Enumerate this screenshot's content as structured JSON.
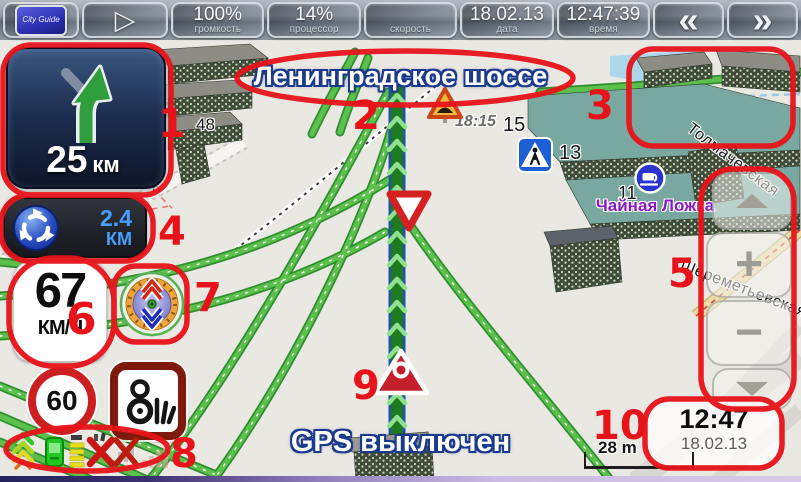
{
  "toolbar": {
    "logo_text": "City Guide",
    "play_glyph": "▷",
    "volume": {
      "value": "100%",
      "label": "громкость"
    },
    "cpu": {
      "value": "14%",
      "label": "процессор"
    },
    "speed": {
      "value": "",
      "label": "скорость"
    },
    "date": {
      "value": "18.02.13",
      "label": "дата"
    },
    "time": {
      "value": "12:47:39",
      "label": "время"
    },
    "back_glyph": "«",
    "forward_glyph": "»"
  },
  "maneuver_panel": {
    "distance": "25",
    "unit": "км"
  },
  "next_maneuver_panel": {
    "distance": "2.4",
    "unit": "КМ"
  },
  "speedometer": {
    "value": "67",
    "unit": "КМ/Ч"
  },
  "speed_limit_sign": {
    "value": "60"
  },
  "zoom_controls": {
    "plus": "+",
    "minus": "−"
  },
  "status_message": "GPS выключен",
  "clock_widget": {
    "time": "12:47",
    "date": "18.02.13"
  },
  "map_scale": {
    "label": "28 m"
  },
  "map_labels": {
    "current_street": "Ленинградское шоссе",
    "street_tolmachevskaya": "Толмачевская",
    "street_sheremetyevskaya": "Шереметьевская",
    "poi_cafe": "Чайная Ложка",
    "traffic_jam_time": "18:15",
    "house_48": "48",
    "house_6": "6",
    "house_15": "15",
    "house_13": "13",
    "house_11": "11"
  },
  "annotations": {
    "n1": "1",
    "n2": "2",
    "n3": "3",
    "n4": "4",
    "n5": "5",
    "n6": "6",
    "n7": "7",
    "n8": "8",
    "n9": "9",
    "n10": "10"
  },
  "colors": {
    "annotation_red": "#e8131a",
    "route_green": "#1e7a1e",
    "hud_accent_blue": "#46a0ff"
  }
}
